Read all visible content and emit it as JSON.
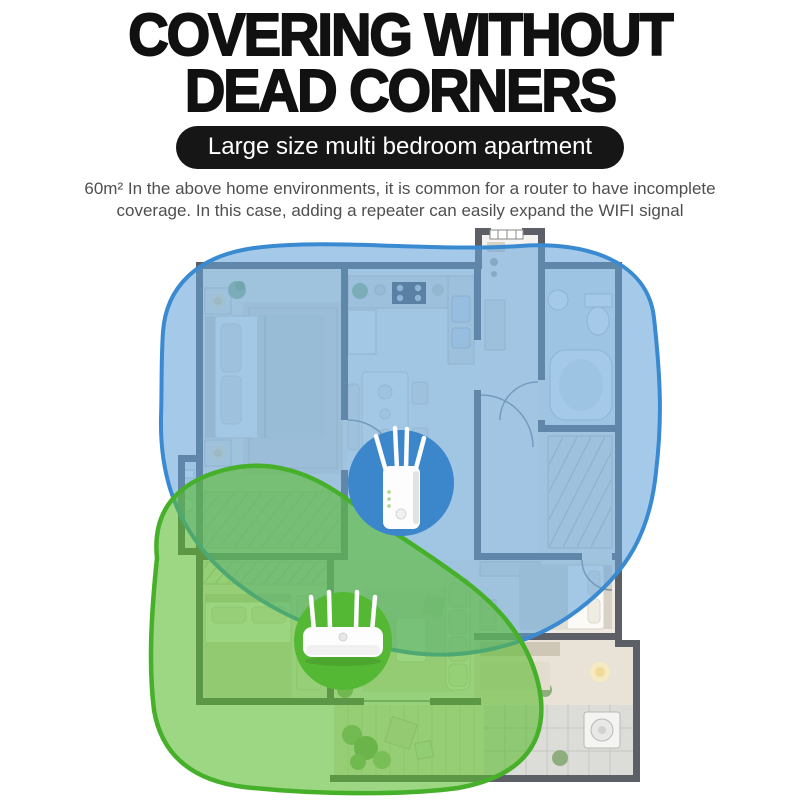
{
  "header": {
    "title_line1": "COVERING WITHOUT",
    "title_line2": "DEAD CORNERS",
    "badge_label": "Large size multi bedroom apartment",
    "description_line1": "60m² In the above home environments, it is common for a router to have incomplete",
    "description_line2": "coverage. In this case, adding a repeater can easily expand the WIFI signal"
  },
  "diagram": {
    "type": "wifi-coverage-floorplan",
    "areas": [
      {
        "id": "repeater-coverage",
        "fill": "rgba(100,164,217,0.58)",
        "stroke": "#3a8ad2"
      },
      {
        "id": "router-coverage",
        "fill": "rgba(91,188,48,0.60)",
        "stroke": "#47b02a"
      }
    ],
    "devices": [
      {
        "id": "wifi-repeater",
        "circle_fill": "#3c86cc"
      },
      {
        "id": "wifi-router",
        "circle_fill": "#55b834"
      }
    ],
    "colors": {
      "wall": "#5c6066",
      "headline": "#111111",
      "badge_bg": "#161616",
      "body_text": "#4f4f4f"
    }
  }
}
